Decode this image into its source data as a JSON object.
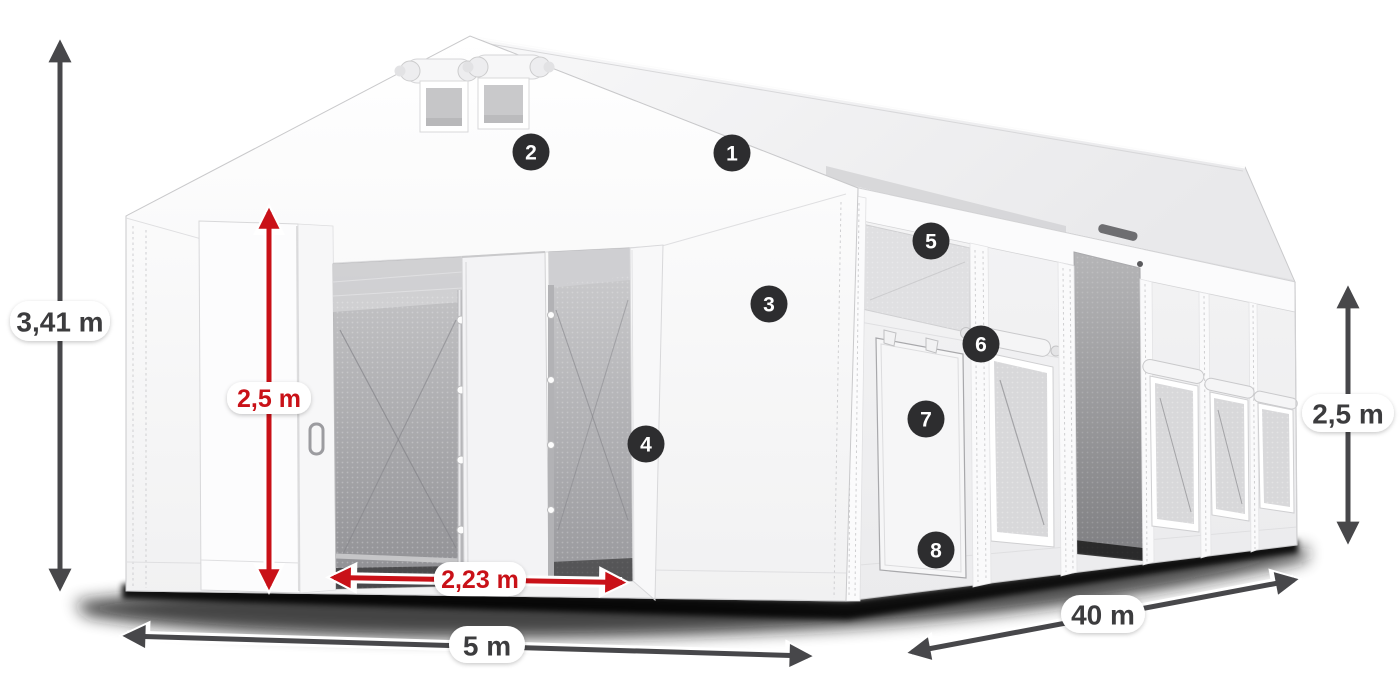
{
  "diagram": {
    "title": "Storage tent 5x40 m dimension diagram",
    "background": "#ffffff",
    "dimensions": {
      "total_height": "3,41 m",
      "door_height": "2,5 m",
      "door_width": "2,23 m",
      "gable_width": "5 m",
      "length": "40 m",
      "side_wall_height": "2,5 m"
    },
    "callouts": [
      "1",
      "2",
      "3",
      "4",
      "5",
      "6",
      "7",
      "8"
    ],
    "colors": {
      "dimension_red": "#c91118",
      "dimension_gray": "#47474a",
      "callout_background": "#2d2d2f",
      "callout_number": "#ffffff",
      "label_background": "#ffffff",
      "label_text_dark": "#3c3c3e",
      "tent_white": "#fafafa",
      "interior_gray": "#97979b"
    }
  }
}
